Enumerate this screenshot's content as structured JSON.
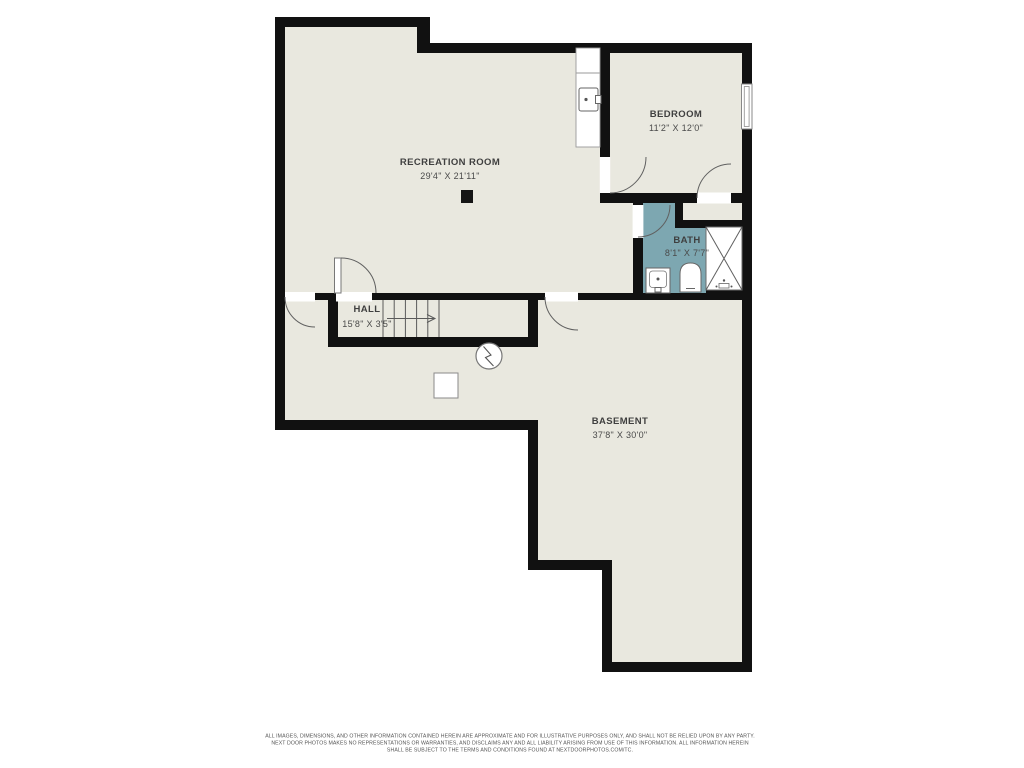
{
  "document": {
    "type": "basement-floor-plan",
    "background": "#ffffff"
  },
  "colors": {
    "wall": "#111111",
    "floor": "#e9e8df",
    "bath": "#7da7b1",
    "door_gap": "#ffffff",
    "fixture_outline": "#666666",
    "label_text": "#3f3f3f",
    "disclaimer_text": "#555555"
  },
  "rooms": [
    {
      "id": "recreation-room",
      "label": "RECREATION ROOM",
      "dimensions": "29'4\" X 21'11\""
    },
    {
      "id": "bedroom",
      "label": "BEDROOM",
      "dimensions": "11'2\" X 12'0\""
    },
    {
      "id": "bath",
      "label": "BATH",
      "dimensions": "8'1\" X 7'7\""
    },
    {
      "id": "hall",
      "label": "HALL",
      "dimensions": "15'8\" X 3'5\""
    },
    {
      "id": "basement",
      "label": "BASEMENT",
      "dimensions": "37'8\" X 30'0\""
    }
  ],
  "symbols": [
    "stairs-with-direction-arrow",
    "door-swing-arc",
    "window",
    "utility-sink-icon",
    "bath-sink-icon",
    "toilet-icon",
    "shower-with-x-icon",
    "smoke-detector-icon",
    "equipment-square",
    "support-column"
  ],
  "footer": {
    "lines": [
      "ALL IMAGES, DIMENSIONS, AND OTHER INFORMATION CONTAINED HEREIN ARE APPROXIMATE AND FOR ILLUSTRATIVE PURPOSES ONLY, AND SHALL NOT BE RELIED UPON BY ANY PARTY.",
      "NEXT DOOR PHOTOS MAKES NO REPRESENTATIONS OR WARRANTIES, AND DISCLAIMS ANY AND ALL LIABILITY ARISING FROM USE OF THIS INFORMATION. ALL INFORMATION HEREIN",
      "SHALL BE SUBJECT TO THE TERMS AND CONDITIONS FOUND AT NEXTDOORPHOTOS.COM/TC."
    ]
  }
}
